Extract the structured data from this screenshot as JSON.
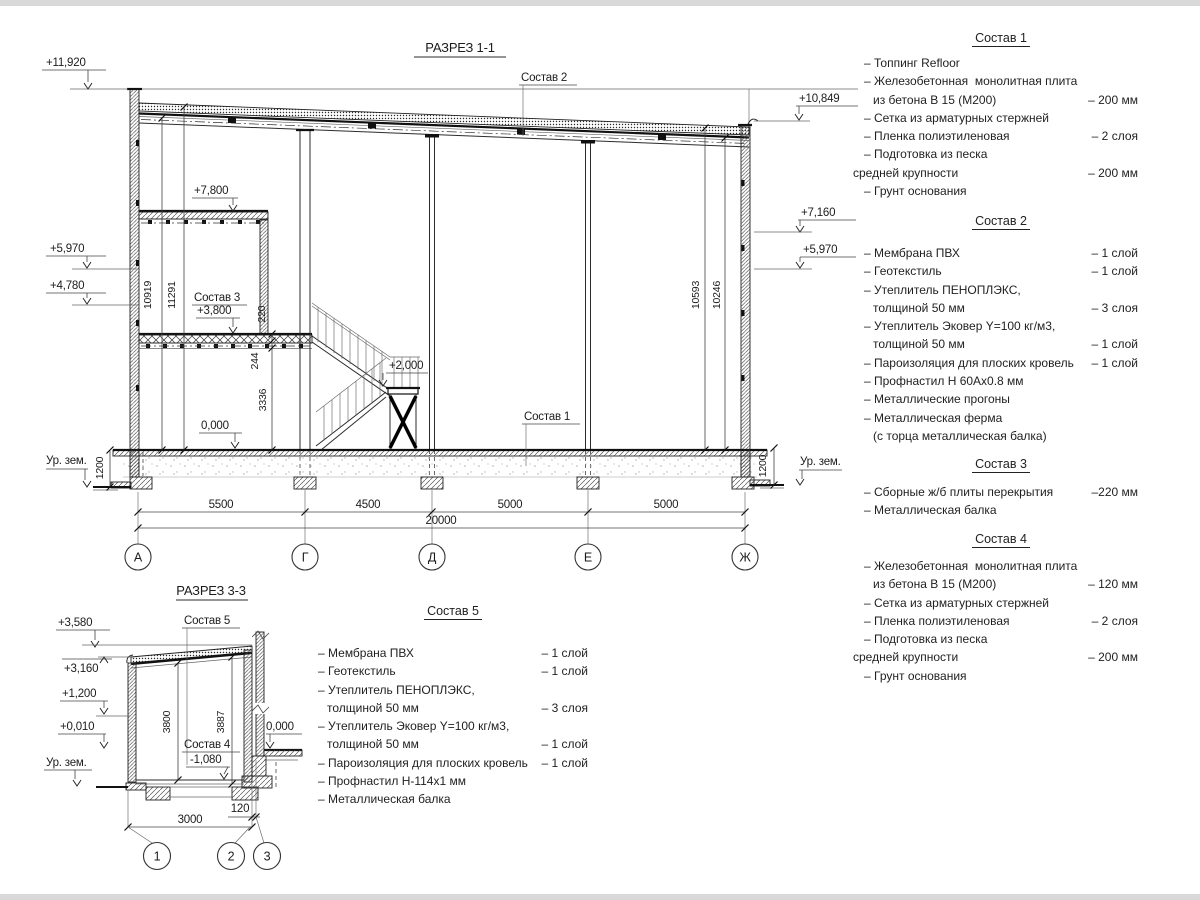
{
  "s1": {
    "title": "РАЗРЕЗ 1-1",
    "c1": "Состав 1",
    "c2": "Состав 2",
    "c3": "Состав 3",
    "lv": {
      "a": "+11,920",
      "b": "+5,970",
      "c": "+4,780",
      "d": "+7,800",
      "e": "+3,800",
      "f": "0,000",
      "g": "+2,000",
      "h": "+10,849",
      "i": "+7,160",
      "j": "+5,970"
    },
    "gl": "Ур. зем.",
    "gr": "Ур. зем.",
    "vd": {
      "a": "10919",
      "b": "11291",
      "c": "220",
      "d": "244",
      "e": "3336",
      "f": "10593",
      "g": "10246",
      "h": "1200",
      "i": "1200"
    },
    "hd": {
      "a": "5500",
      "b": "4500",
      "c": "5000",
      "d": "5000",
      "e": "20000"
    },
    "ax": [
      "А",
      "Г",
      "Д",
      "Е",
      "Ж"
    ]
  },
  "s3": {
    "title": "РАЗРЕЗ 3-3",
    "c5": "Состав 5",
    "c4": "Состав 4",
    "lv": {
      "a": "+3,580",
      "b": "+3,160",
      "c": "+1,200",
      "d": "+0,010",
      "e": "-1,080",
      "f": "0,000"
    },
    "g": "Ур. зем.",
    "vd": {
      "a": "3800",
      "b": "3887"
    },
    "hd": {
      "a": "3000",
      "b": "120"
    },
    "ax": [
      "1",
      "2",
      "3"
    ]
  },
  "comps": [
    {
      "title": "Состав 1",
      "rows": [
        {
          "t": "– Топпинг Refloor",
          "v": ""
        },
        {
          "t": "– Железобетонная  монолитная плита",
          "v": ""
        },
        {
          "t": "из бетона В 15 (М200)",
          "v": "– 200 мм"
        },
        {
          "t": "– Сетка из арматурных стержней",
          "v": ""
        },
        {
          "t": "– Пленка полиэтиленовая",
          "v": "– 2 слоя"
        },
        {
          "t": "– Подготовка из песка",
          "v": ""
        },
        {
          "t": "средней крупности",
          "v": "– 200 мм"
        },
        {
          "t": "– Грунт основания",
          "v": ""
        }
      ]
    },
    {
      "title": "Состав 2",
      "rows": [
        {
          "t": "– Мембрана ПВХ",
          "v": "– 1 слой"
        },
        {
          "t": "– Геотекстиль",
          "v": "– 1 слой"
        },
        {
          "t": "– Утеплитель ПЕНОПЛЭКС,",
          "v": ""
        },
        {
          "t": "толщиной 50 мм",
          "v": "– 3 слоя"
        },
        {
          "t": "– Утеплитель Эковер Y=100 кг/м3,",
          "v": ""
        },
        {
          "t": "толщиной 50 мм",
          "v": "– 1 слой"
        },
        {
          "t": "– Пароизоляция для плоских кровель",
          "v": "– 1 слой"
        },
        {
          "t": "– Профнастил Н 60Ах0.8 мм",
          "v": ""
        },
        {
          "t": "– Металлические прогоны",
          "v": ""
        },
        {
          "t": "– Металлическая ферма",
          "v": ""
        },
        {
          "t": "(с торца металлическая балка)",
          "v": ""
        }
      ]
    },
    {
      "title": "Состав 3",
      "rows": [
        {
          "t": "– Сборные ж/б плиты перекрытия",
          "v": "–220 мм"
        },
        {
          "t": "– Металлическая балка",
          "v": ""
        }
      ]
    },
    {
      "title": "Состав 4",
      "rows": [
        {
          "t": "– Железобетонная  монолитная плита",
          "v": ""
        },
        {
          "t": "из бетона В 15 (М200)",
          "v": "– 120 мм"
        },
        {
          "t": "– Сетка из арматурных стержней",
          "v": ""
        },
        {
          "t": "– Пленка полиэтиленовая",
          "v": "– 2 слоя"
        },
        {
          "t": "– Подготовка из песка",
          "v": ""
        },
        {
          "t": "средней крупности",
          "v": "– 200 мм"
        },
        {
          "t": "– Грунт основания",
          "v": ""
        }
      ]
    },
    {
      "title": "Состав 5",
      "rows": [
        {
          "t": "– Мембрана ПВХ",
          "v": "– 1 слой"
        },
        {
          "t": "– Геотекстиль",
          "v": "– 1 слой"
        },
        {
          "t": "– Утеплитель ПЕНОПЛЭКС,",
          "v": ""
        },
        {
          "t": "толщиной 50 мм",
          "v": "– 3 слоя"
        },
        {
          "t": "– Утеплитель Эковер Y=100 кг/м3,",
          "v": ""
        },
        {
          "t": "толщиной 50 мм",
          "v": "– 1 слой"
        },
        {
          "t": "– Пароизоляция для плоских кровель",
          "v": "– 1 слой"
        },
        {
          "t": "– Профнастил Н-114х1 мм",
          "v": ""
        },
        {
          "t": "– Металлическая балка",
          "v": ""
        }
      ]
    }
  ]
}
